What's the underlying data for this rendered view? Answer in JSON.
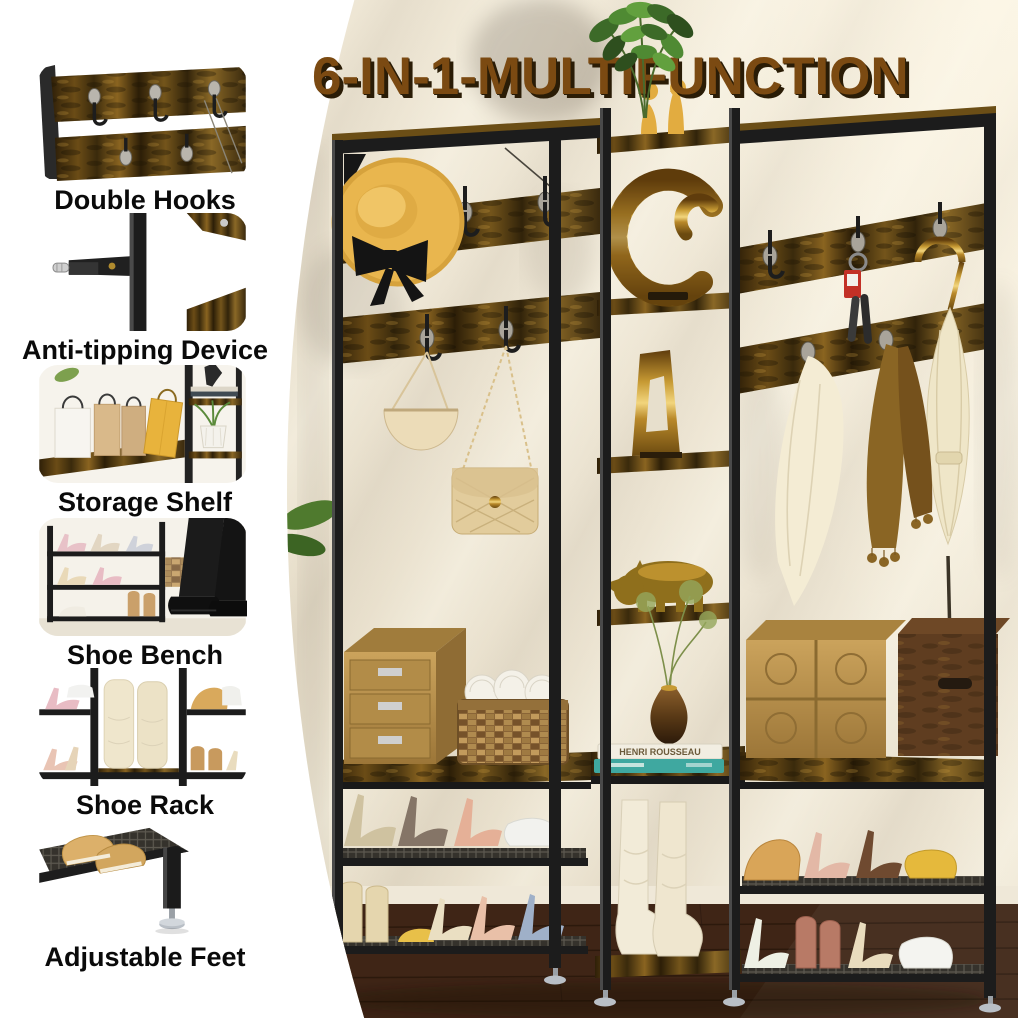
{
  "title": "6-IN-1-MULTIFUNCTION",
  "sidebar": {
    "items": [
      {
        "id": "double-hooks",
        "label": "Double Hooks"
      },
      {
        "id": "anti-tipping-device",
        "label": "Anti-tipping Device"
      },
      {
        "id": "storage-shelf",
        "label": "Storage Shelf"
      },
      {
        "id": "shoe-bench",
        "label": "Shoe Bench"
      },
      {
        "id": "shoe-rack",
        "label": "Shoe Rack"
      },
      {
        "id": "adjustable-feet",
        "label": "Adjustable Feet"
      }
    ]
  },
  "photo": {
    "description": "hall tree with hooks, shelves, shoe bench and racks",
    "book_spine_title": "HENRI ROUSSEAU"
  },
  "colors": {
    "wall": "#EBE4D3",
    "title-color": "#7B4A12",
    "title-shadow": "#2A1C06",
    "metal": "#1C1C1C",
    "label-color": "#0A0A0A",
    "floor": "#3A2315"
  }
}
